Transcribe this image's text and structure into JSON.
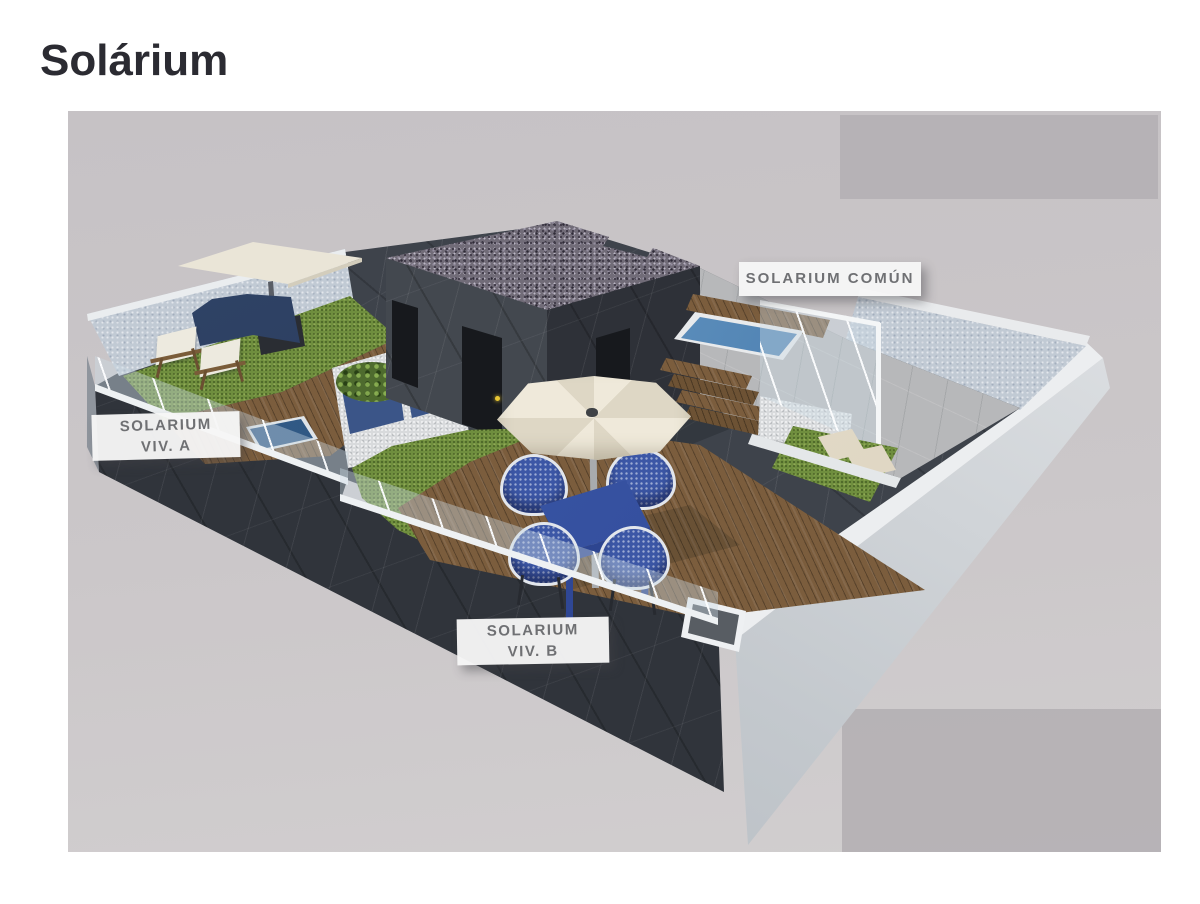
{
  "title": "Solárium",
  "labels": {
    "comun": "SOLARIUM COMÚN",
    "viv_a": [
      "SOLARIUM",
      "VIV. A"
    ],
    "viv_b": [
      "SOLARIUM",
      "VIV. B"
    ]
  },
  "palette": {
    "title_text": "#2b2b32",
    "canvas_bg": "#c9c5c7",
    "canvas_band": "#b4b0b4",
    "dark_marble_wall": "#30343b",
    "white_wall": "#c3c8cd",
    "textured_wall": "#c1cad4",
    "wood_deck": "#7b5d3d",
    "grass_green": "#6f8e3e",
    "pool_water_blue": "#4678ab",
    "furniture_blue": "#3c57a6",
    "umbrella_cream": "#e9e3d4",
    "sail_navy": "#2e4166",
    "gravel_roof": "#716c78",
    "label_bg": "#f6f6f6",
    "label_text": "#6f7073"
  }
}
